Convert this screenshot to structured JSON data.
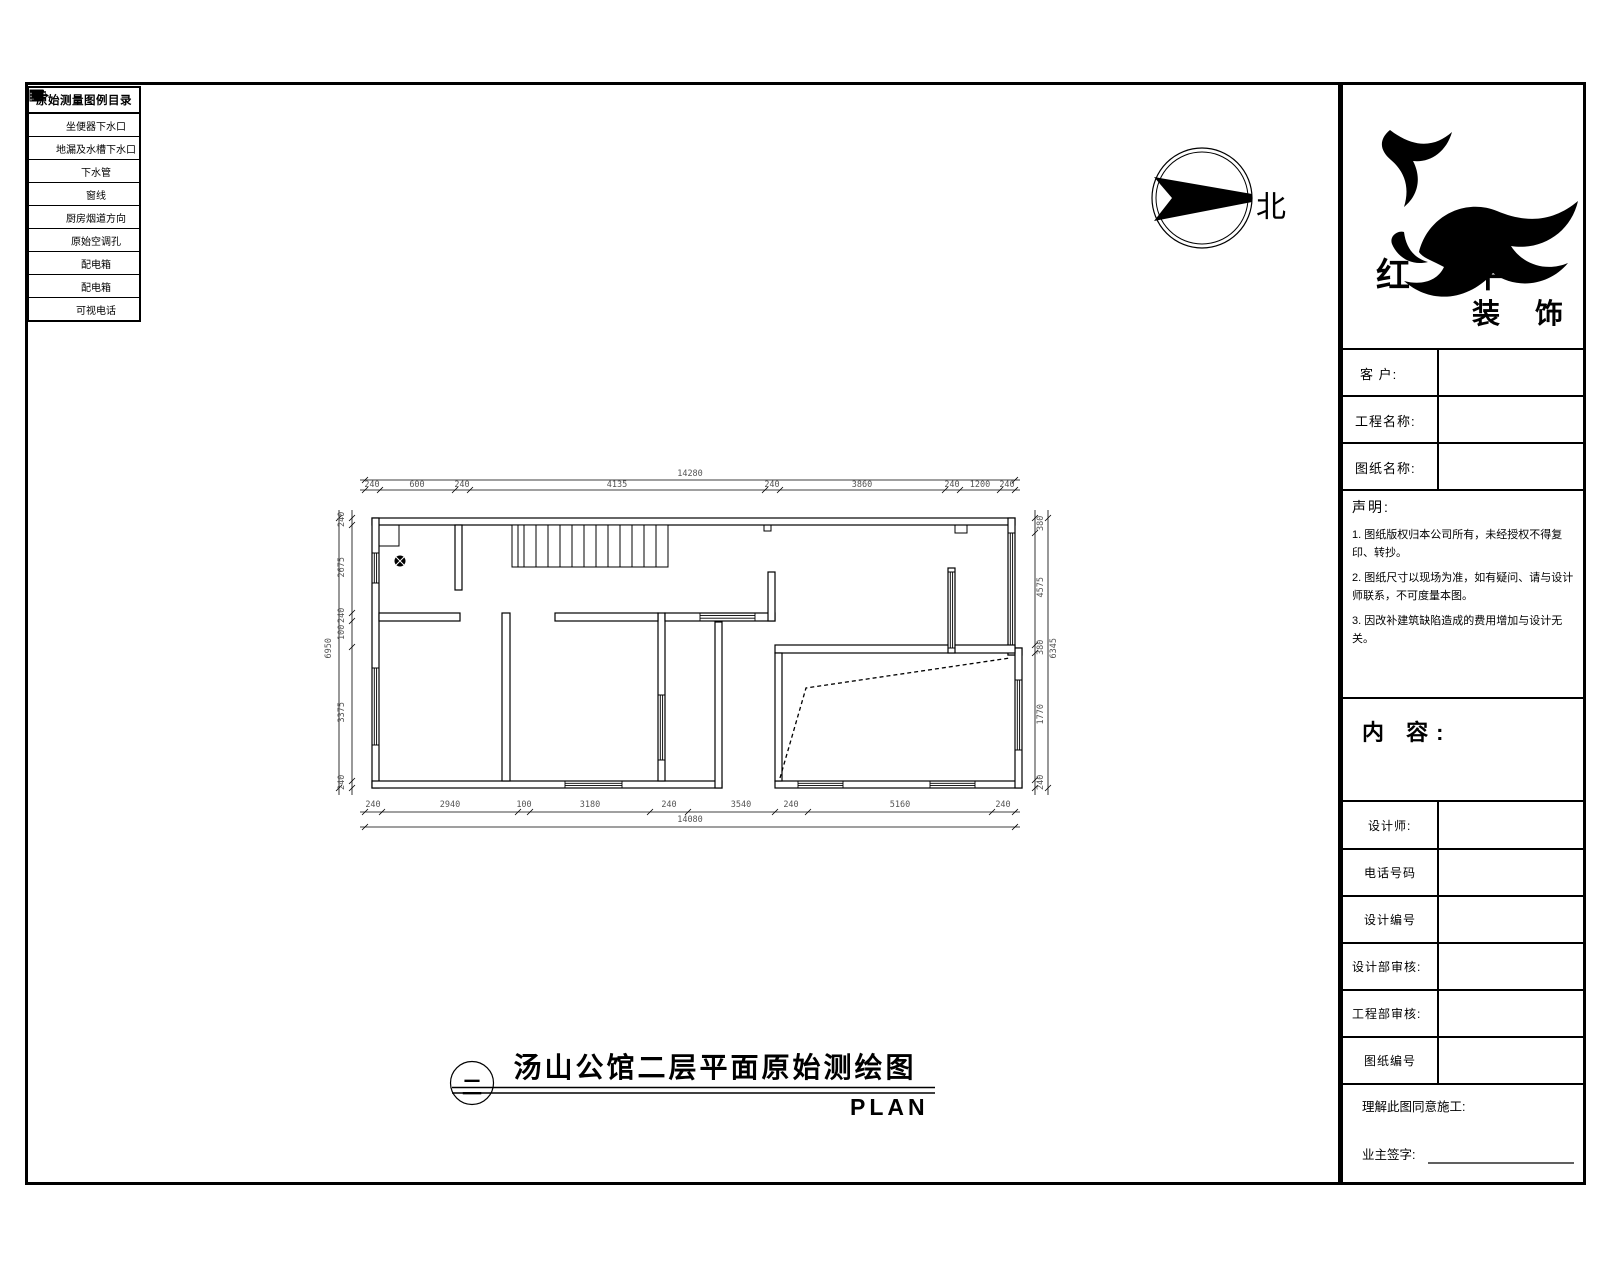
{
  "legend": {
    "title": "原始测量图例目录",
    "items": [
      {
        "icon": "toilet-drain-icon",
        "label": "坐便器下水口"
      },
      {
        "icon": "floor-drain-icon",
        "label": "地漏及水槽下水口"
      },
      {
        "icon": "drain-pipe-icon",
        "label": "下水管"
      },
      {
        "icon": "window-line-icon",
        "label": "窗线"
      },
      {
        "icon": "kitchen-flue-icon",
        "label": "厨房烟道方向"
      },
      {
        "icon": "ac-hole-icon",
        "label": "原始空调孔"
      },
      {
        "icon": "power-box-icon",
        "label": "配电箱"
      },
      {
        "icon": "weak-power-box-icon",
        "label": "配电箱"
      },
      {
        "icon": "video-phone-icon",
        "label": "可视电话"
      }
    ]
  },
  "compass": {
    "label": "北"
  },
  "brand": {
    "line1": "红 牛",
    "line2": "装 饰"
  },
  "titleblock": {
    "client_label": "客  户:",
    "project_label": "工程名称:",
    "drawing_label": "图纸名称:",
    "statement_title": "声明:",
    "statement_items": [
      "1. 图纸版权归本公司所有，未经授权不得复印、转抄。",
      "2. 图纸尺寸以现场为准，如有疑问、请与设计师联系，不可度量本图。",
      "3. 因改补建筑缺陷造成的费用增加与设计无关。"
    ],
    "content_label": "内 容:",
    "designer_label": "设计师:",
    "phone_label": "电话号码",
    "design_no_label": "设计编号",
    "design_audit_label": "设计部审核:",
    "eng_audit_label": "工程部审核:",
    "drawing_no_label": "图纸编号",
    "approve_label": "理解此图同意施工:",
    "owner_sign_label": "业主签字:"
  },
  "plan": {
    "title": "汤山公馆二层平面原始测绘图",
    "floor_mark": "二",
    "subtitle": "PLAN"
  },
  "dims": {
    "top": {
      "segments": [
        "240",
        "600",
        "240",
        "4135",
        "240",
        "3860",
        "240",
        "1200",
        "240"
      ],
      "total": "14280"
    },
    "bottom": {
      "segments": [
        "240",
        "2940",
        "100",
        "3180",
        "240",
        "3540",
        "240",
        "5160",
        "240"
      ],
      "total": "14080"
    },
    "left": {
      "segments": [
        "240",
        "2675",
        "240",
        "100",
        "3375",
        "240"
      ],
      "total": "6950"
    },
    "right": {
      "segments": [
        "380",
        "4575",
        "380",
        "1770",
        "240"
      ],
      "total": "6345"
    }
  }
}
